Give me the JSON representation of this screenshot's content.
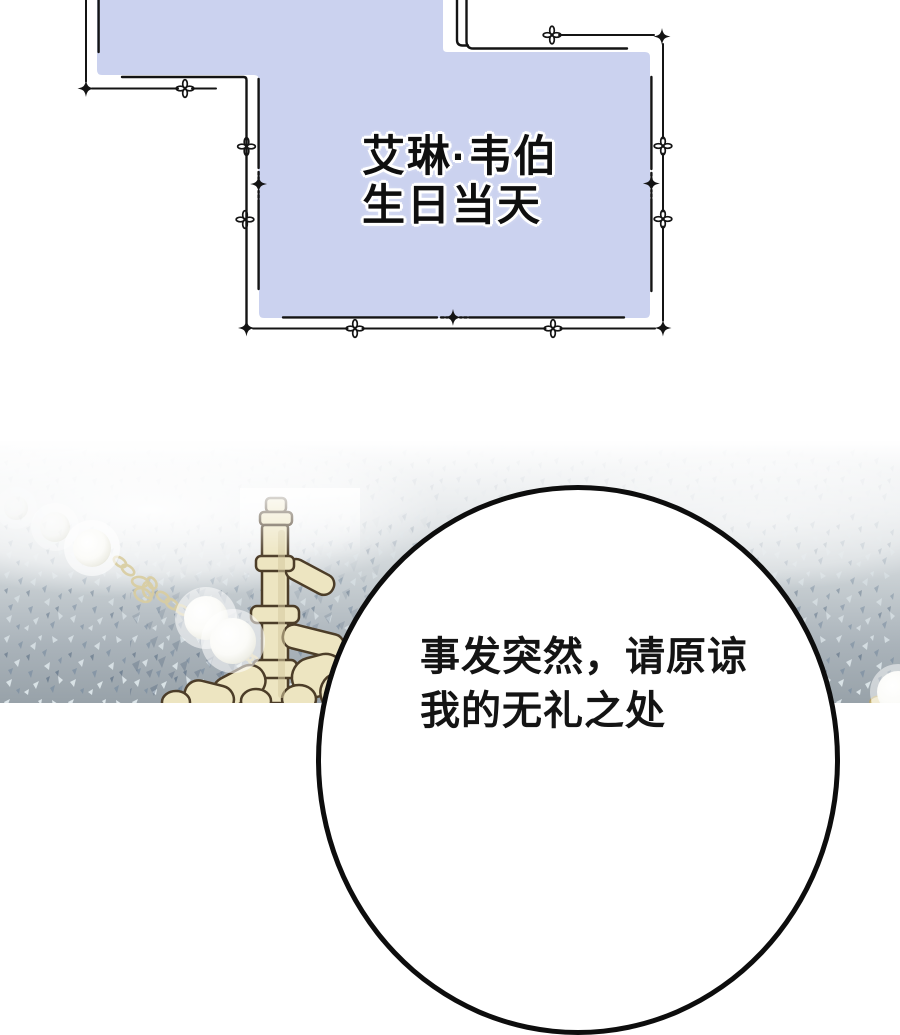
{
  "caption_box": {
    "line1": "艾琳·韦伯",
    "line2": "生日当天",
    "fill": "#cbd2ef",
    "line_color": "#141414"
  },
  "speech_bubble": {
    "line1": "事发突然，请原谅",
    "line2": "我的无礼之处",
    "fill": "#ffffff",
    "border": "#0d0d0d",
    "text_color": "#141414"
  },
  "artwork": {
    "ornament_icons": [
      "diamond-ornament-icon",
      "clover-ornament-icon"
    ],
    "pearl_color": "#ffffff",
    "chain_color": "#d9cda0",
    "bone_color": "#ede5c1",
    "bone_outline": "#4c3d28",
    "texture_base": "#a0aab1",
    "speckle_light": "#dde6ea",
    "speckle_dark": "#6e8095"
  }
}
